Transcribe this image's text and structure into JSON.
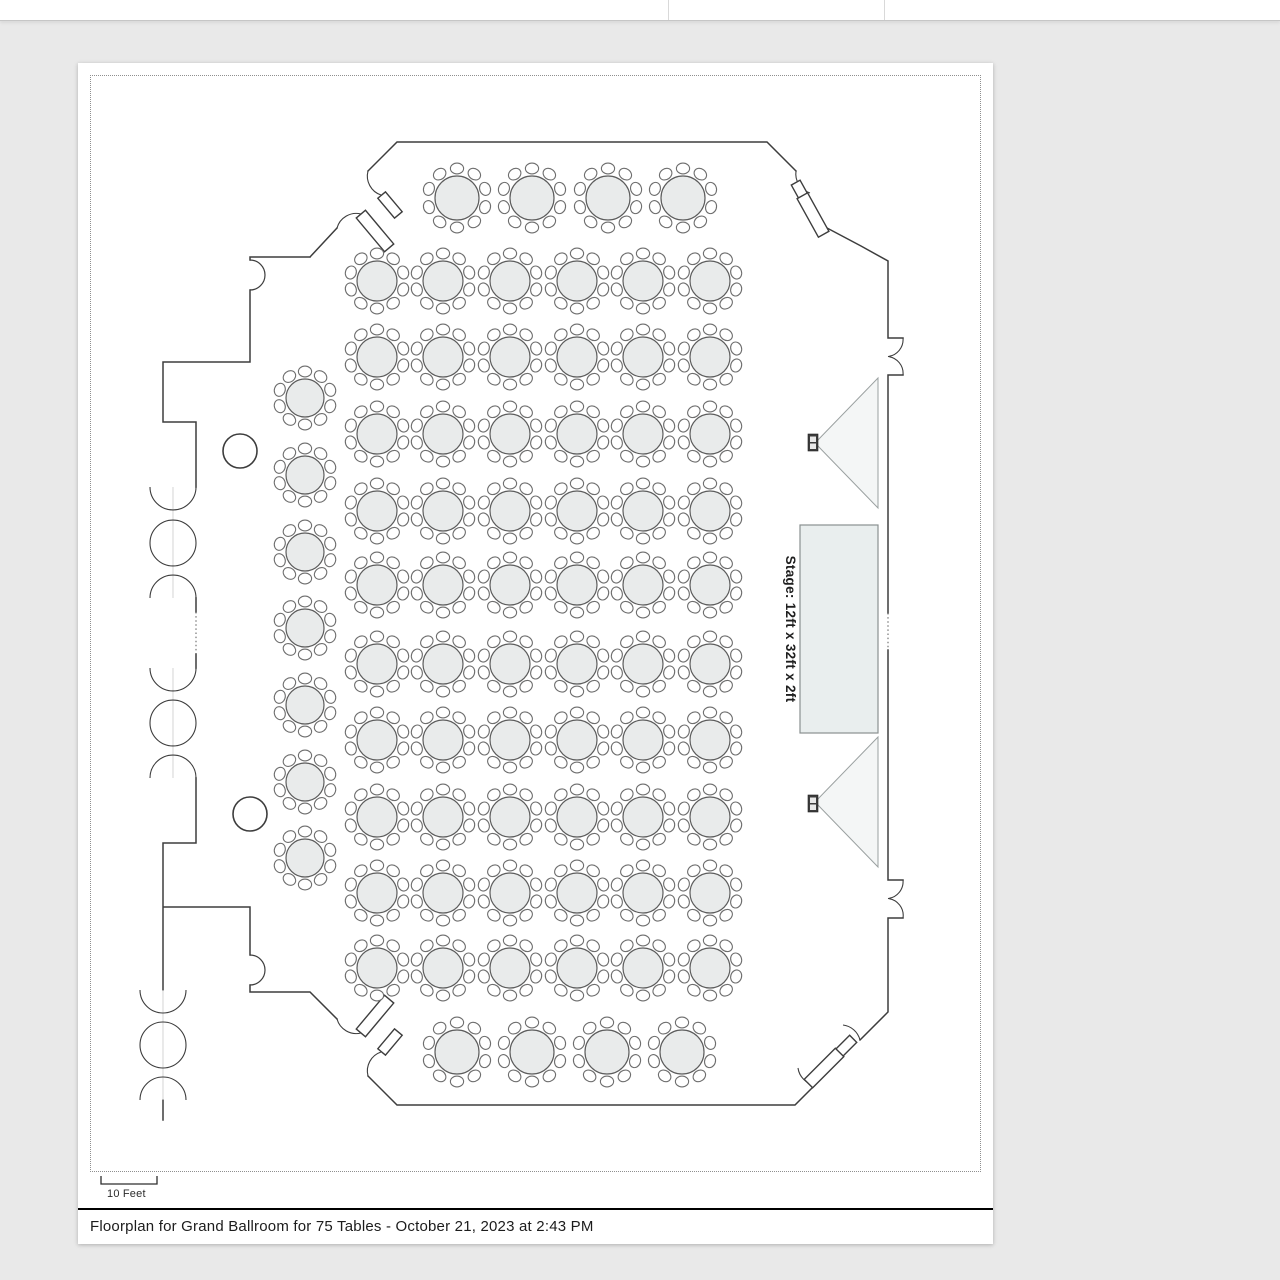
{
  "window": {
    "topbar_dividers_x": [
      668,
      884
    ]
  },
  "document": {
    "caption": "Floorplan for Grand Ballroom for 75 Tables - October 21, 2023 at 2:43 PM",
    "scale_label": "10 Feet"
  },
  "floorplan": {
    "stage": {
      "label": "Stage: 12ft x 32ft x 2ft",
      "x": 800,
      "y": 525,
      "width": 78,
      "height": 208,
      "label_x": 786,
      "label_y": 629
    },
    "speakers": [
      {
        "name": "speaker-top",
        "points": "878,378 878,508 815,443",
        "box_x": 808,
        "box_y": 434
      },
      {
        "name": "speaker-bottom",
        "points": "878,737 878,867 815,802",
        "box_x": 808,
        "box_y": 795
      }
    ],
    "columns": [
      {
        "cx": 240,
        "cy": 451,
        "r": 17
      },
      {
        "cx": 250,
        "cy": 814,
        "r": 17
      }
    ],
    "tables": {
      "total": 75,
      "chairs_per_table": 10,
      "groups": [
        {
          "name": "top-row",
          "r": 22,
          "y": 198,
          "xs": [
            457,
            532,
            608,
            683
          ]
        },
        {
          "name": "main-grid",
          "r": 20,
          "cols": [
            377,
            443,
            510,
            577,
            643,
            710
          ],
          "rows": [
            281,
            357,
            434,
            511,
            585,
            664,
            740,
            817,
            893,
            968
          ]
        },
        {
          "name": "left-column",
          "r": 19,
          "x": 305,
          "ys": [
            398,
            475,
            552,
            628,
            705,
            782,
            858
          ]
        },
        {
          "name": "bottom-row",
          "r": 22,
          "y": 1052,
          "xs": [
            457,
            532,
            607,
            682
          ]
        }
      ]
    }
  },
  "colors": {
    "background": "#e9e9e9",
    "page": "#ffffff",
    "wall": "#3d3d3d",
    "table_fill": "#e9ebeb",
    "chair_fill": "#ffffff",
    "stage_fill": "#e9eeee",
    "caption_rule": "#000000"
  }
}
